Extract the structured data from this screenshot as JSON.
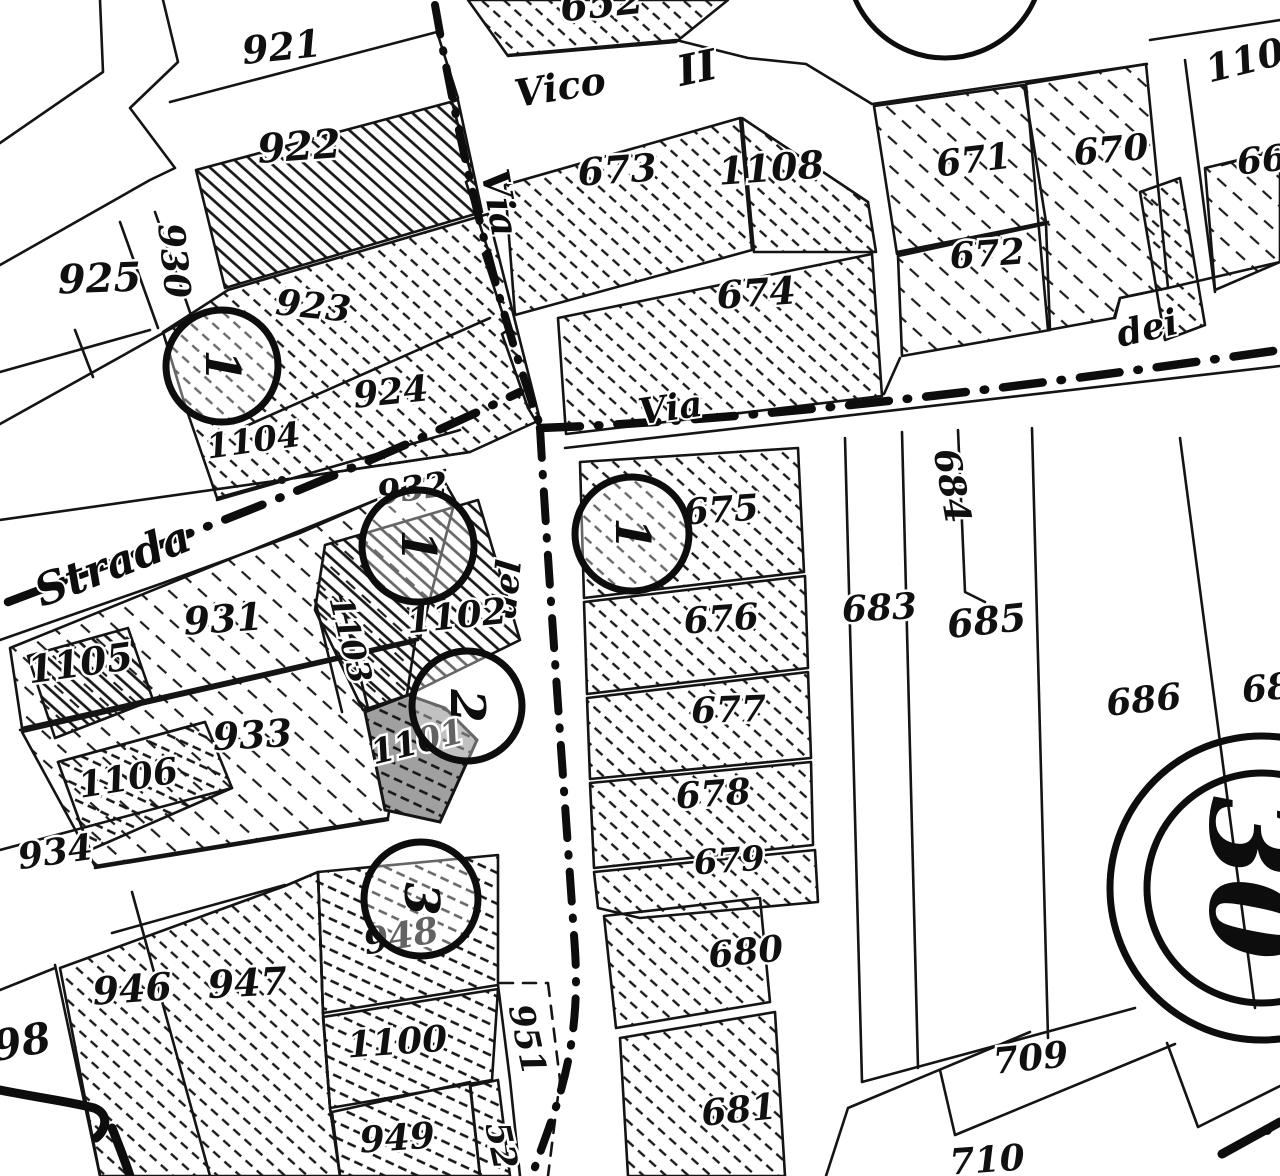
{
  "map": {
    "type": "cadastral-map-scan",
    "colors": {
      "ink": "#141414",
      "paper": "#ffffff",
      "shaded_parcel": "#a0a0a0"
    },
    "streets": [
      {
        "name": "Strada",
        "x": 118,
        "y": 578,
        "rot": -21,
        "size": 44
      },
      {
        "name": "Via",
        "x": 487,
        "y": 205,
        "rot": 80,
        "size": 38
      },
      {
        "name": "Vico",
        "x": 562,
        "y": 100,
        "rot": -9,
        "size": 38
      },
      {
        "name": "II",
        "x": 700,
        "y": 82,
        "rot": -12,
        "size": 42
      },
      {
        "name": "Via",
        "x": 672,
        "y": 420,
        "rot": -8,
        "size": 36
      },
      {
        "name": "dei",
        "x": 1150,
        "y": 340,
        "rot": -13,
        "size": 36
      },
      {
        "name": "del",
        "x": 518,
        "y": 590,
        "rot": -84,
        "size": 34
      }
    ],
    "parcels": [
      {
        "label": "921",
        "x": 283,
        "y": 60,
        "rot": -6,
        "size": 38
      },
      {
        "label": "922",
        "x": 300,
        "y": 160,
        "rot": -4,
        "size": 40
      },
      {
        "label": "925",
        "x": 100,
        "y": 292,
        "rot": -2,
        "size": 40
      },
      {
        "label": "930",
        "x": 162,
        "y": 262,
        "rot": 84,
        "size": 36
      },
      {
        "label": "923",
        "x": 312,
        "y": 318,
        "rot": 6,
        "size": 36
      },
      {
        "label": "924",
        "x": 392,
        "y": 404,
        "rot": -6,
        "size": 36
      },
      {
        "label": "1104",
        "x": 255,
        "y": 452,
        "rot": -8,
        "size": 34
      },
      {
        "label": "932",
        "x": 414,
        "y": 500,
        "rot": -8,
        "size": 34
      },
      {
        "label": "1103",
        "x": 340,
        "y": 642,
        "rot": 76,
        "size": 32
      },
      {
        "label": "1102",
        "x": 458,
        "y": 628,
        "rot": -6,
        "size": 36
      },
      {
        "label": "931",
        "x": 224,
        "y": 632,
        "rot": -4,
        "size": 38
      },
      {
        "label": "1105",
        "x": 82,
        "y": 676,
        "rot": -8,
        "size": 38
      },
      {
        "label": "933",
        "x": 253,
        "y": 748,
        "rot": -3,
        "size": 38
      },
      {
        "label": "1106",
        "x": 130,
        "y": 790,
        "rot": -9,
        "size": 36
      },
      {
        "label": "1101",
        "x": 420,
        "y": 753,
        "rot": -14,
        "size": 34
      },
      {
        "label": "934",
        "x": 57,
        "y": 864,
        "rot": -8,
        "size": 36
      },
      {
        "label": "946",
        "x": 133,
        "y": 1002,
        "rot": -4,
        "size": 38
      },
      {
        "label": "947",
        "x": 248,
        "y": 996,
        "rot": -3,
        "size": 38
      },
      {
        "label": "98",
        "x": 24,
        "y": 1056,
        "rot": -10,
        "size": 42
      },
      {
        "label": "948",
        "x": 403,
        "y": 948,
        "rot": -10,
        "size": 36
      },
      {
        "label": "1100",
        "x": 398,
        "y": 1054,
        "rot": -4,
        "size": 36
      },
      {
        "label": "951",
        "x": 516,
        "y": 1042,
        "rot": 78,
        "size": 34
      },
      {
        "label": "949",
        "x": 398,
        "y": 1150,
        "rot": -4,
        "size": 36
      },
      {
        "label": "52",
        "x": 490,
        "y": 1148,
        "rot": 78,
        "size": 34
      },
      {
        "label": "652",
        "x": 603,
        "y": 17,
        "rot": -6,
        "size": 40
      },
      {
        "label": "673",
        "x": 618,
        "y": 183,
        "rot": -4,
        "size": 38
      },
      {
        "label": "1108",
        "x": 772,
        "y": 181,
        "rot": -4,
        "size": 38
      },
      {
        "label": "674",
        "x": 757,
        "y": 306,
        "rot": -4,
        "size": 38
      },
      {
        "label": "671",
        "x": 975,
        "y": 172,
        "rot": -7,
        "size": 36
      },
      {
        "label": "670",
        "x": 1112,
        "y": 162,
        "rot": -5,
        "size": 36
      },
      {
        "label": "672",
        "x": 988,
        "y": 266,
        "rot": -4,
        "size": 36
      },
      {
        "label": "110",
        "x": 1248,
        "y": 73,
        "rot": -14,
        "size": 38
      },
      {
        "label": "66",
        "x": 1263,
        "y": 172,
        "rot": -6,
        "size": 36
      },
      {
        "label": "675",
        "x": 722,
        "y": 522,
        "rot": -4,
        "size": 36
      },
      {
        "label": "676",
        "x": 722,
        "y": 631,
        "rot": -4,
        "size": 36
      },
      {
        "label": "677",
        "x": 729,
        "y": 722,
        "rot": -2,
        "size": 36
      },
      {
        "label": "678",
        "x": 714,
        "y": 806,
        "rot": -4,
        "size": 36
      },
      {
        "label": "679",
        "x": 730,
        "y": 872,
        "rot": -4,
        "size": 34
      },
      {
        "label": "680",
        "x": 747,
        "y": 964,
        "rot": -6,
        "size": 36
      },
      {
        "label": "681",
        "x": 740,
        "y": 1122,
        "rot": -6,
        "size": 36
      },
      {
        "label": "684",
        "x": 940,
        "y": 488,
        "rot": 80,
        "size": 36
      },
      {
        "label": "683",
        "x": 880,
        "y": 620,
        "rot": -3,
        "size": 36
      },
      {
        "label": "685",
        "x": 988,
        "y": 634,
        "rot": -6,
        "size": 38
      },
      {
        "label": "686",
        "x": 1145,
        "y": 712,
        "rot": -6,
        "size": 36
      },
      {
        "label": "68",
        "x": 1268,
        "y": 700,
        "rot": -6,
        "size": 36
      },
      {
        "label": "709",
        "x": 1032,
        "y": 1070,
        "rot": -6,
        "size": 36
      },
      {
        "label": "710",
        "x": 988,
        "y": 1172,
        "rot": -4,
        "size": 36
      }
    ],
    "circled_refs": [
      {
        "digit": "1",
        "cx": 222,
        "cy": 366,
        "r": 56,
        "rot": 90,
        "size": 48,
        "opaque": true
      },
      {
        "digit": "1",
        "cx": 418,
        "cy": 546,
        "r": 56,
        "rot": 90,
        "size": 48,
        "opaque": false
      },
      {
        "digit": "1",
        "cx": 632,
        "cy": 534,
        "r": 57,
        "rot": 90,
        "size": 48,
        "opaque": false
      },
      {
        "digit": "2",
        "cx": 467,
        "cy": 706,
        "r": 55,
        "rot": 90,
        "size": 48,
        "opaque": false
      },
      {
        "digit": "3",
        "cx": 421,
        "cy": 899,
        "r": 57,
        "rot": 90,
        "size": 48,
        "opaque": false
      }
    ],
    "sheet_marker": {
      "label": "30",
      "cx": 1262,
      "cy": 888,
      "rot": 90,
      "size": 118,
      "rings": [
        115,
        152
      ]
    }
  }
}
